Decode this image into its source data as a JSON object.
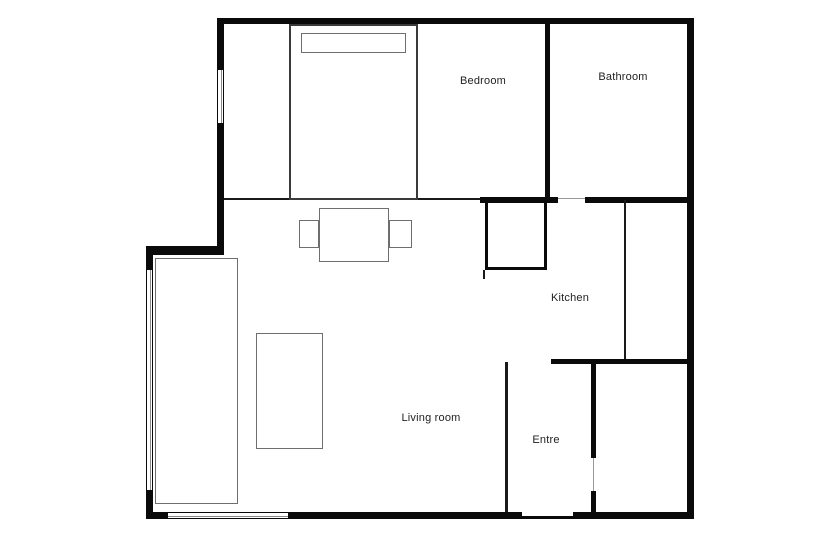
{
  "floorplan": {
    "rooms": [
      {
        "name": "bedroom",
        "label": "Bedroom"
      },
      {
        "name": "bathroom",
        "label": "Bathroom"
      },
      {
        "name": "kitchen",
        "label": "Kitchen"
      },
      {
        "name": "living-room",
        "label": "Living room"
      },
      {
        "name": "entre",
        "label": "Entre"
      }
    ],
    "icons": {
      "bed": "bed-furniture-icon",
      "pillow": "pillow-icon",
      "dining_table": "dining-table-icon",
      "sofa": "sofa-icon",
      "coffee_table": "coffee-table-icon",
      "closet": "closet-icon"
    },
    "colors": {
      "wall": "#0a0a0a",
      "furniture_outline": "#6e6e6e",
      "background": "#ffffff",
      "text": "#222222"
    }
  }
}
